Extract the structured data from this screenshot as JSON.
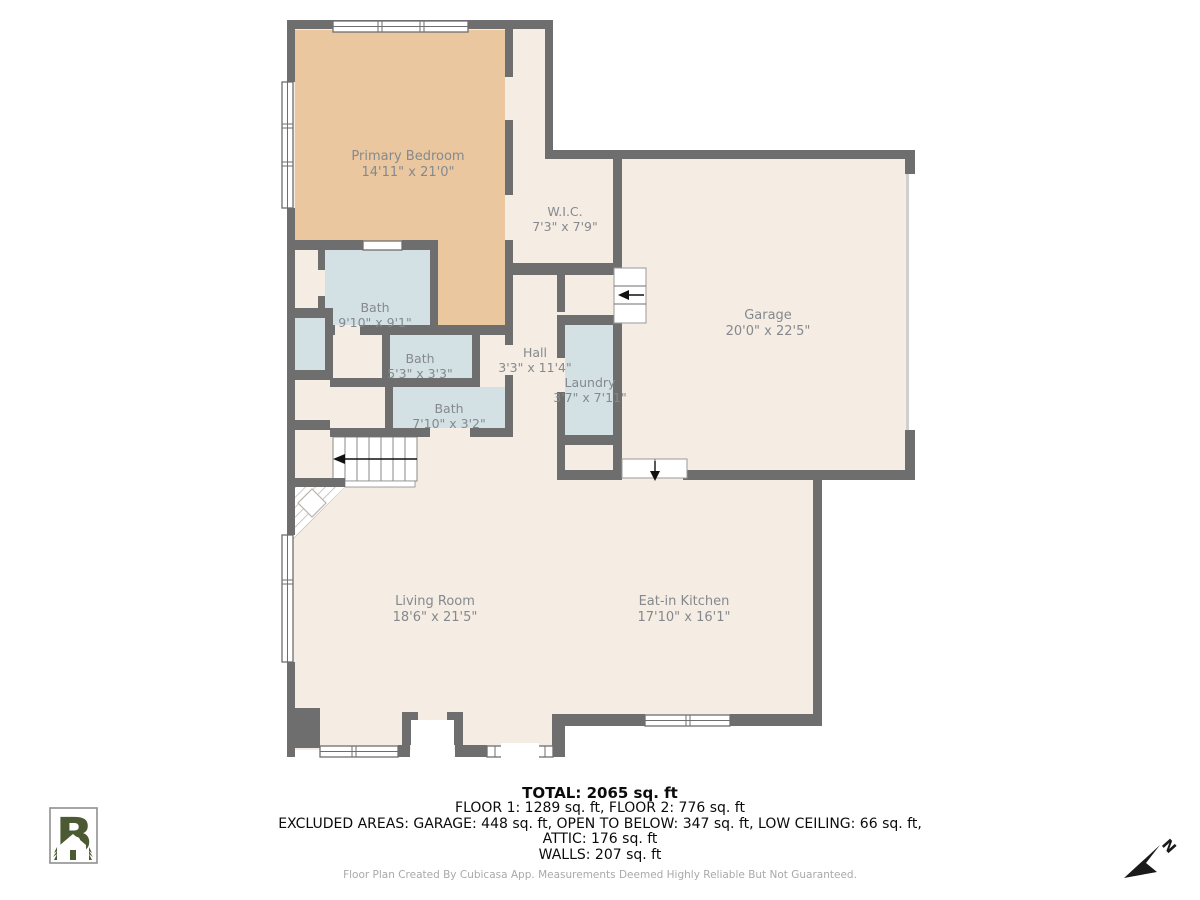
{
  "plan": {
    "rooms": [
      {
        "name": "Primary Bedroom",
        "dims": "14'11\" x 21'0\""
      },
      {
        "name": "W.I.C.",
        "dims": "7'3\" x 7'9\""
      },
      {
        "name": "Garage",
        "dims": "20'0\" x 22'5\""
      },
      {
        "name": "Bath",
        "dims": "9'10\" x 9'1\""
      },
      {
        "name": "Bath",
        "dims": "5'3\" x 3'3\""
      },
      {
        "name": "Hall",
        "dims": "3'3\" x 11'4\""
      },
      {
        "name": "Laundry",
        "dims": "3'7\" x 7'11\""
      },
      {
        "name": "Bath",
        "dims": "7'10\" x 3'2\""
      },
      {
        "name": "Living Room",
        "dims": "18'6\" x 21'5\""
      },
      {
        "name": "Eat-in Kitchen",
        "dims": "17'10\" x 16'1\""
      }
    ]
  },
  "summary": {
    "total": "TOTAL: 2065 sq. ft",
    "floors": "FLOOR 1: 1289 sq. ft, FLOOR 2: 776 sq. ft",
    "excluded": "EXCLUDED AREAS: GARAGE: 448 sq. ft, OPEN TO BELOW: 347 sq. ft, LOW CEILING: 66 sq. ft,",
    "attic": "ATTIC: 176 sq. ft",
    "walls": "WALLS: 207 sq. ft"
  },
  "footer": {
    "text": "Floor Plan Created By Cubicasa App. Measurements Deemed Highly Reliable But Not Guaranteed."
  },
  "compass": {
    "label": "N"
  },
  "brand": {
    "letter": "B"
  },
  "colors": {
    "wall": "#6e6e6e",
    "floor": "#f5ece4",
    "bedroom": "#ebc7a0",
    "wet": "#d3e1e4",
    "logo_green": "#4b5a33"
  }
}
